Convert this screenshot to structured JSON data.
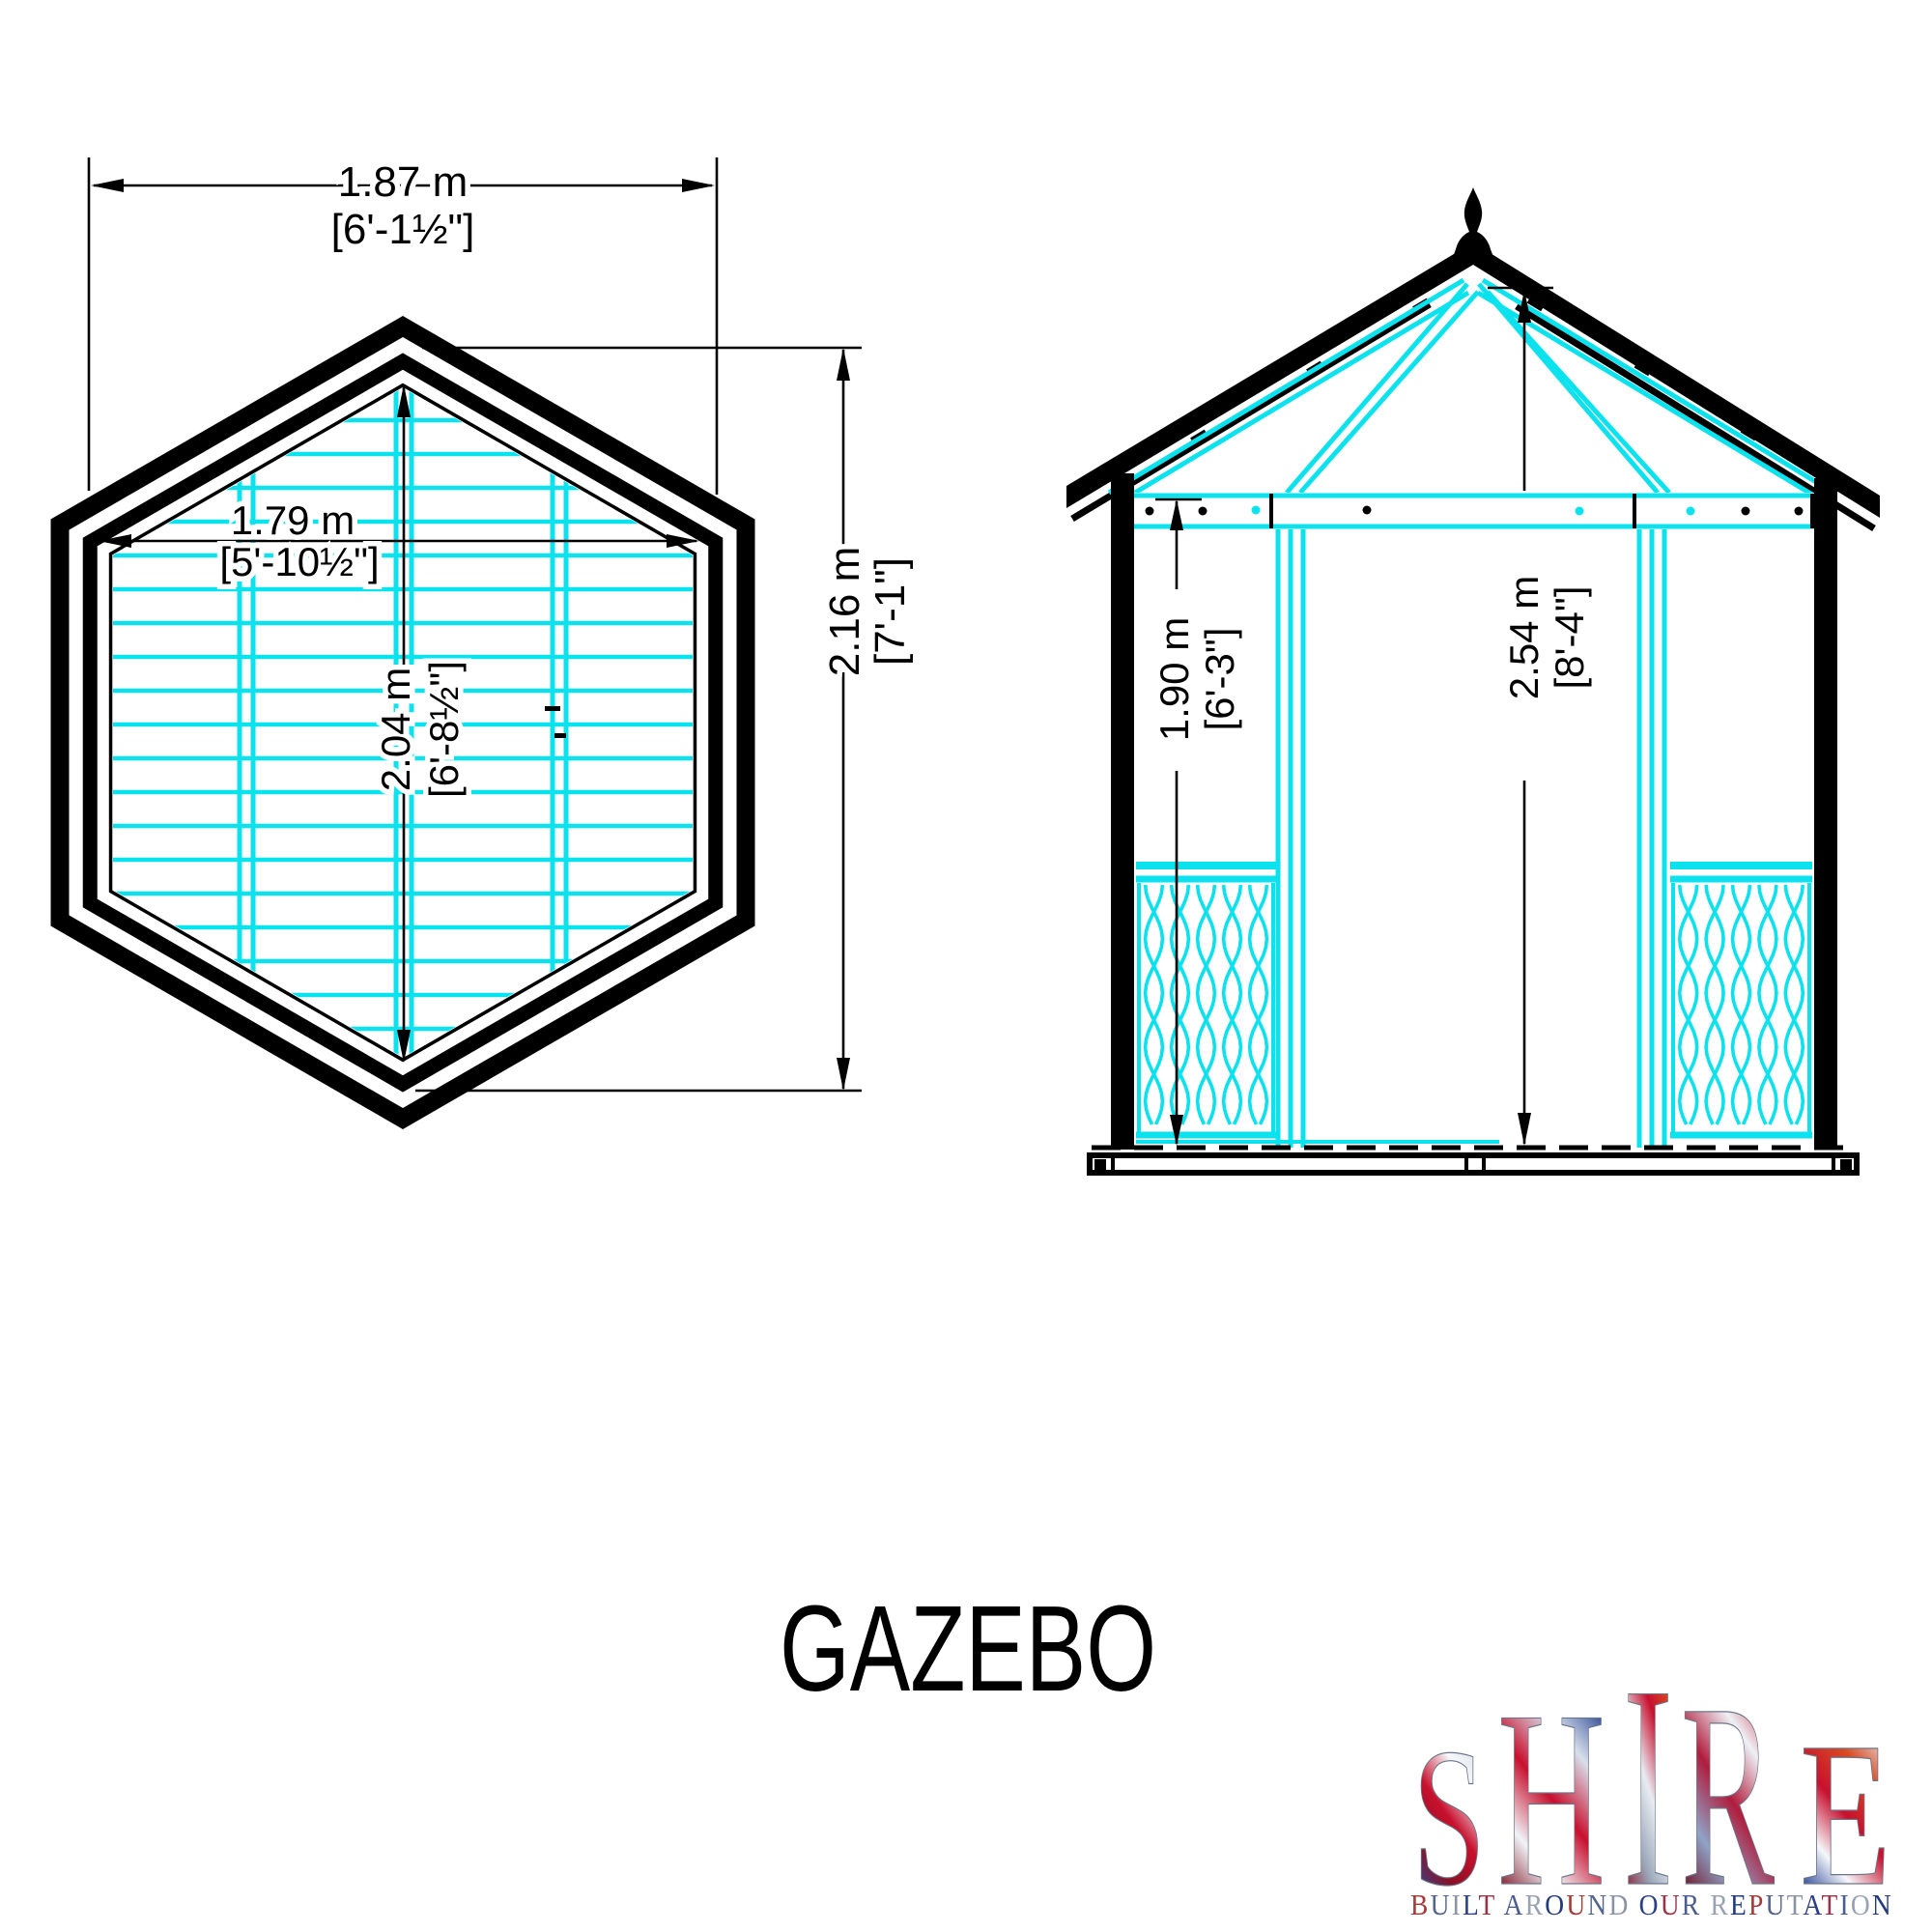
{
  "drawing_title": "GAZEBO",
  "palette": {
    "line_black": "#000000",
    "cad_cyan": "#0ce2ee",
    "background": "#ffffff"
  },
  "plan_view": {
    "dim_overall_width": {
      "metric": "1.87 m",
      "imperial": "[6'-1½\"]"
    },
    "dim_floor_width": {
      "metric": "1.79 m",
      "imperial": "[5'-10½\"]"
    },
    "dim_floor_depth": {
      "metric": "2.04 m",
      "imperial": "[6'-8½\"]"
    },
    "dim_overall_depth": {
      "metric": "2.16 m",
      "imperial": "[7'-1\"]"
    }
  },
  "elevation_view": {
    "dim_wall_height": {
      "metric": "1.90 m",
      "imperial": "[6'-3\"]"
    },
    "dim_total_height": {
      "metric": "2.54 m",
      "imperial": "[8'-4\"]"
    }
  },
  "logo": {
    "brand": "SHIRE",
    "tagline": "BUILT AROUND OUR REPUTATION",
    "letter_gradients": [
      [
        "#d9dfe9",
        "#f5f7fa",
        "#c8102e",
        "#8c1022",
        "#2b4a9b"
      ],
      [
        "#1d3a8f",
        "#d8e0ec",
        "#c8102e",
        "#f0f3f7",
        "#7c1020"
      ],
      [
        "#e05a1e",
        "#c8102e",
        "#e8ecf2",
        "#9aa6b8",
        "#8c1326"
      ],
      [
        "#c8102e",
        "#eef1f6",
        "#b01c3c",
        "#8fa3c8",
        "#6e0d1e"
      ],
      [
        "#e8ecf2",
        "#d84a20",
        "#c8102e",
        "#f5f7fa",
        "#1d3a8f"
      ]
    ],
    "tagline_palette": [
      "#a23c3a",
      "#54658d",
      "#8b94a3",
      "#2a3f85",
      "#963549",
      "#4a5d92",
      "#99a2b1",
      "#203a7e"
    ]
  }
}
